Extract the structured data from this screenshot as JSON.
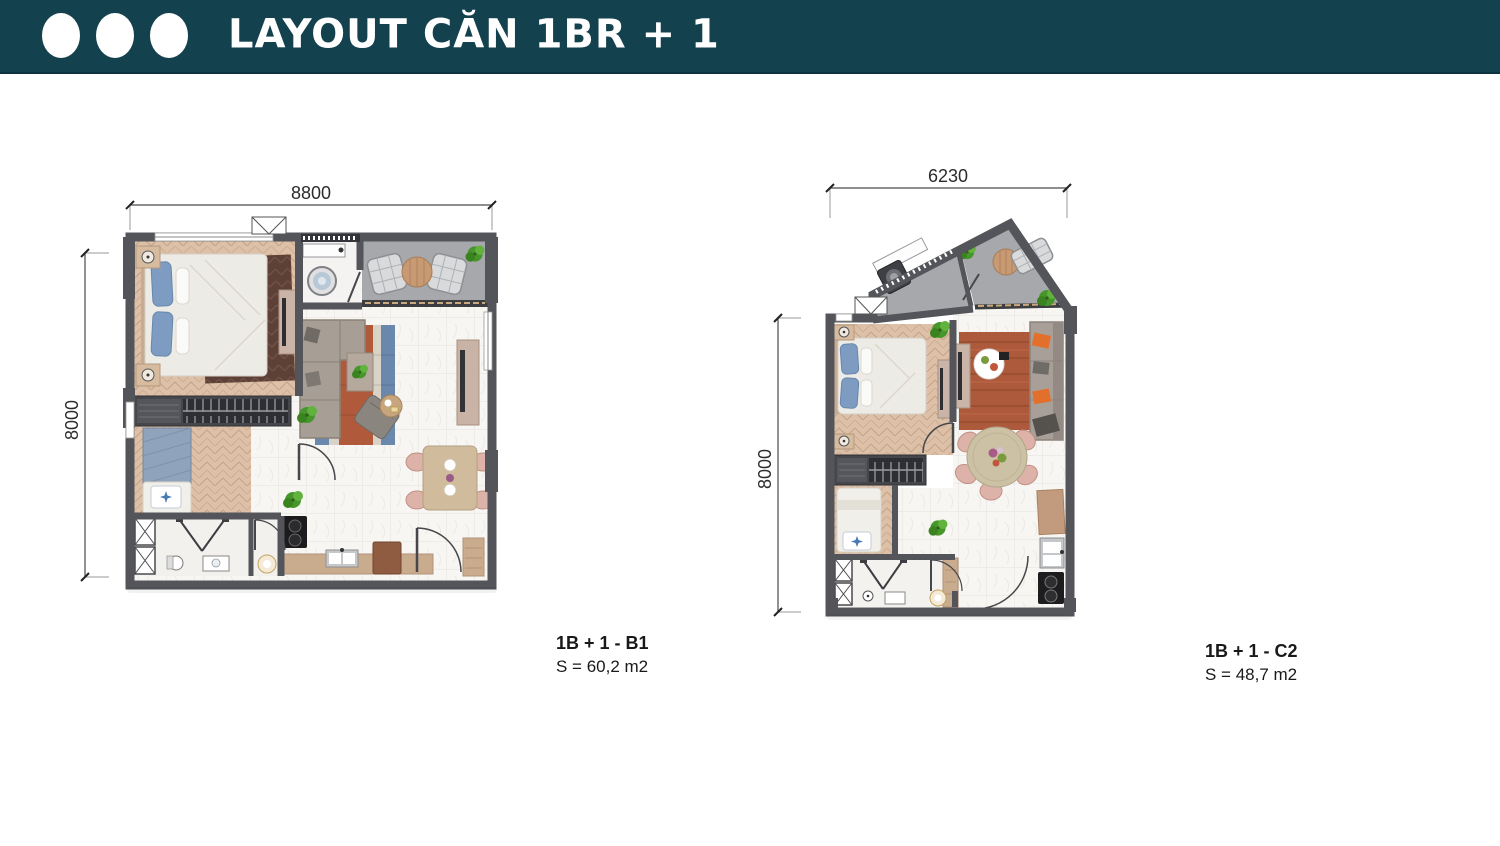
{
  "header": {
    "title": "LAYOUT CĂN 1BR + 1"
  },
  "plans": [
    {
      "id": "B1",
      "name": "1B + 1 - B1",
      "area": "S = 60,2 m2",
      "width_label": "8800",
      "height_label": "8000"
    },
    {
      "id": "C2",
      "name": "1B + 1 - C2",
      "area": "S = 48,7 m2",
      "width_label": "6230",
      "height_label": "8000"
    }
  ],
  "palette": {
    "header_bg": "#14414e",
    "wall": "#54555a",
    "wood_floor": "#dcc0a8",
    "marble_floor": "#f7f6f3",
    "balcony_floor": "#a7a8ab",
    "bedroom_rug": "#5e4136",
    "living_rug_rust": "#b0593b",
    "living_rug_blue": "#6a87ac",
    "pillow_blue": "#7e9cc2",
    "pillow_orange": "#e2702c",
    "chair_pink": "#ddb3a9",
    "plant_green": "#47962c",
    "counter_tan": "#c9ab8e"
  }
}
